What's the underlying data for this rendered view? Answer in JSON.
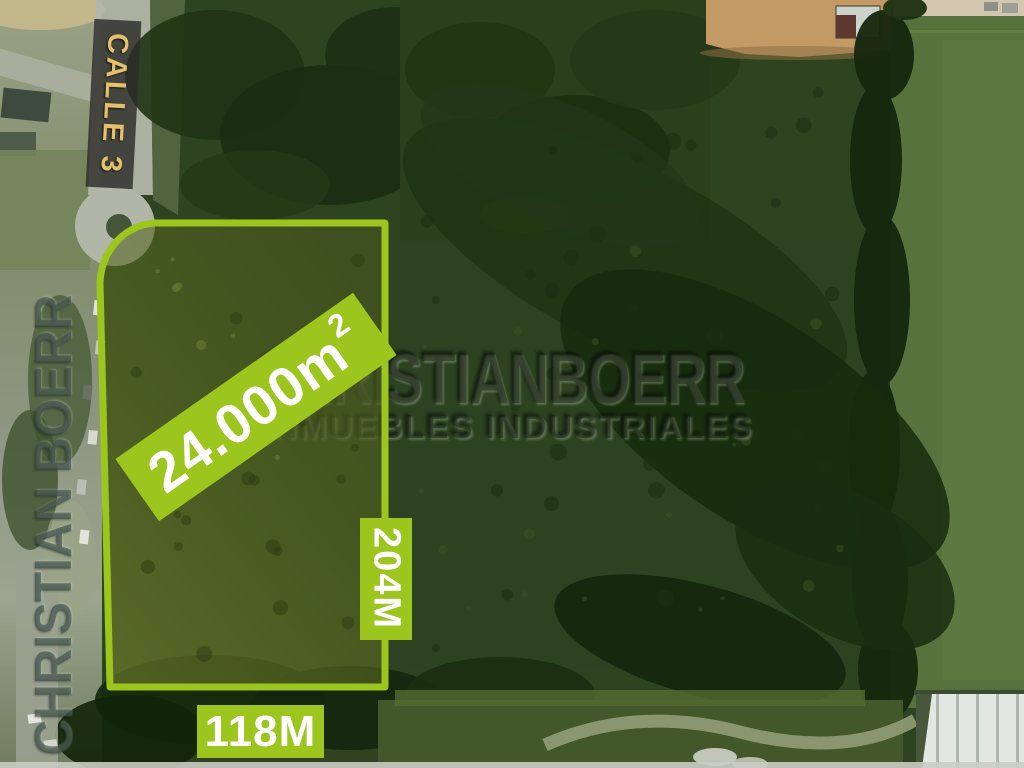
{
  "listing": {
    "street_label": "CALLE 3",
    "area_value": "24.000m",
    "area_superscript": "2",
    "side_length_label": "204M",
    "frontage_label": "118M"
  },
  "watermark": {
    "brand": "CHRISTIANBOERR",
    "tagline": "INMUEBLES INDUSTRIALES",
    "vertical_brand": "CHRISTIAN BOERR"
  },
  "colors": {
    "annotation_green": "#9CC51D",
    "street_label_gold": "#E3C16B",
    "annotation_text": "#FFFFFF"
  }
}
